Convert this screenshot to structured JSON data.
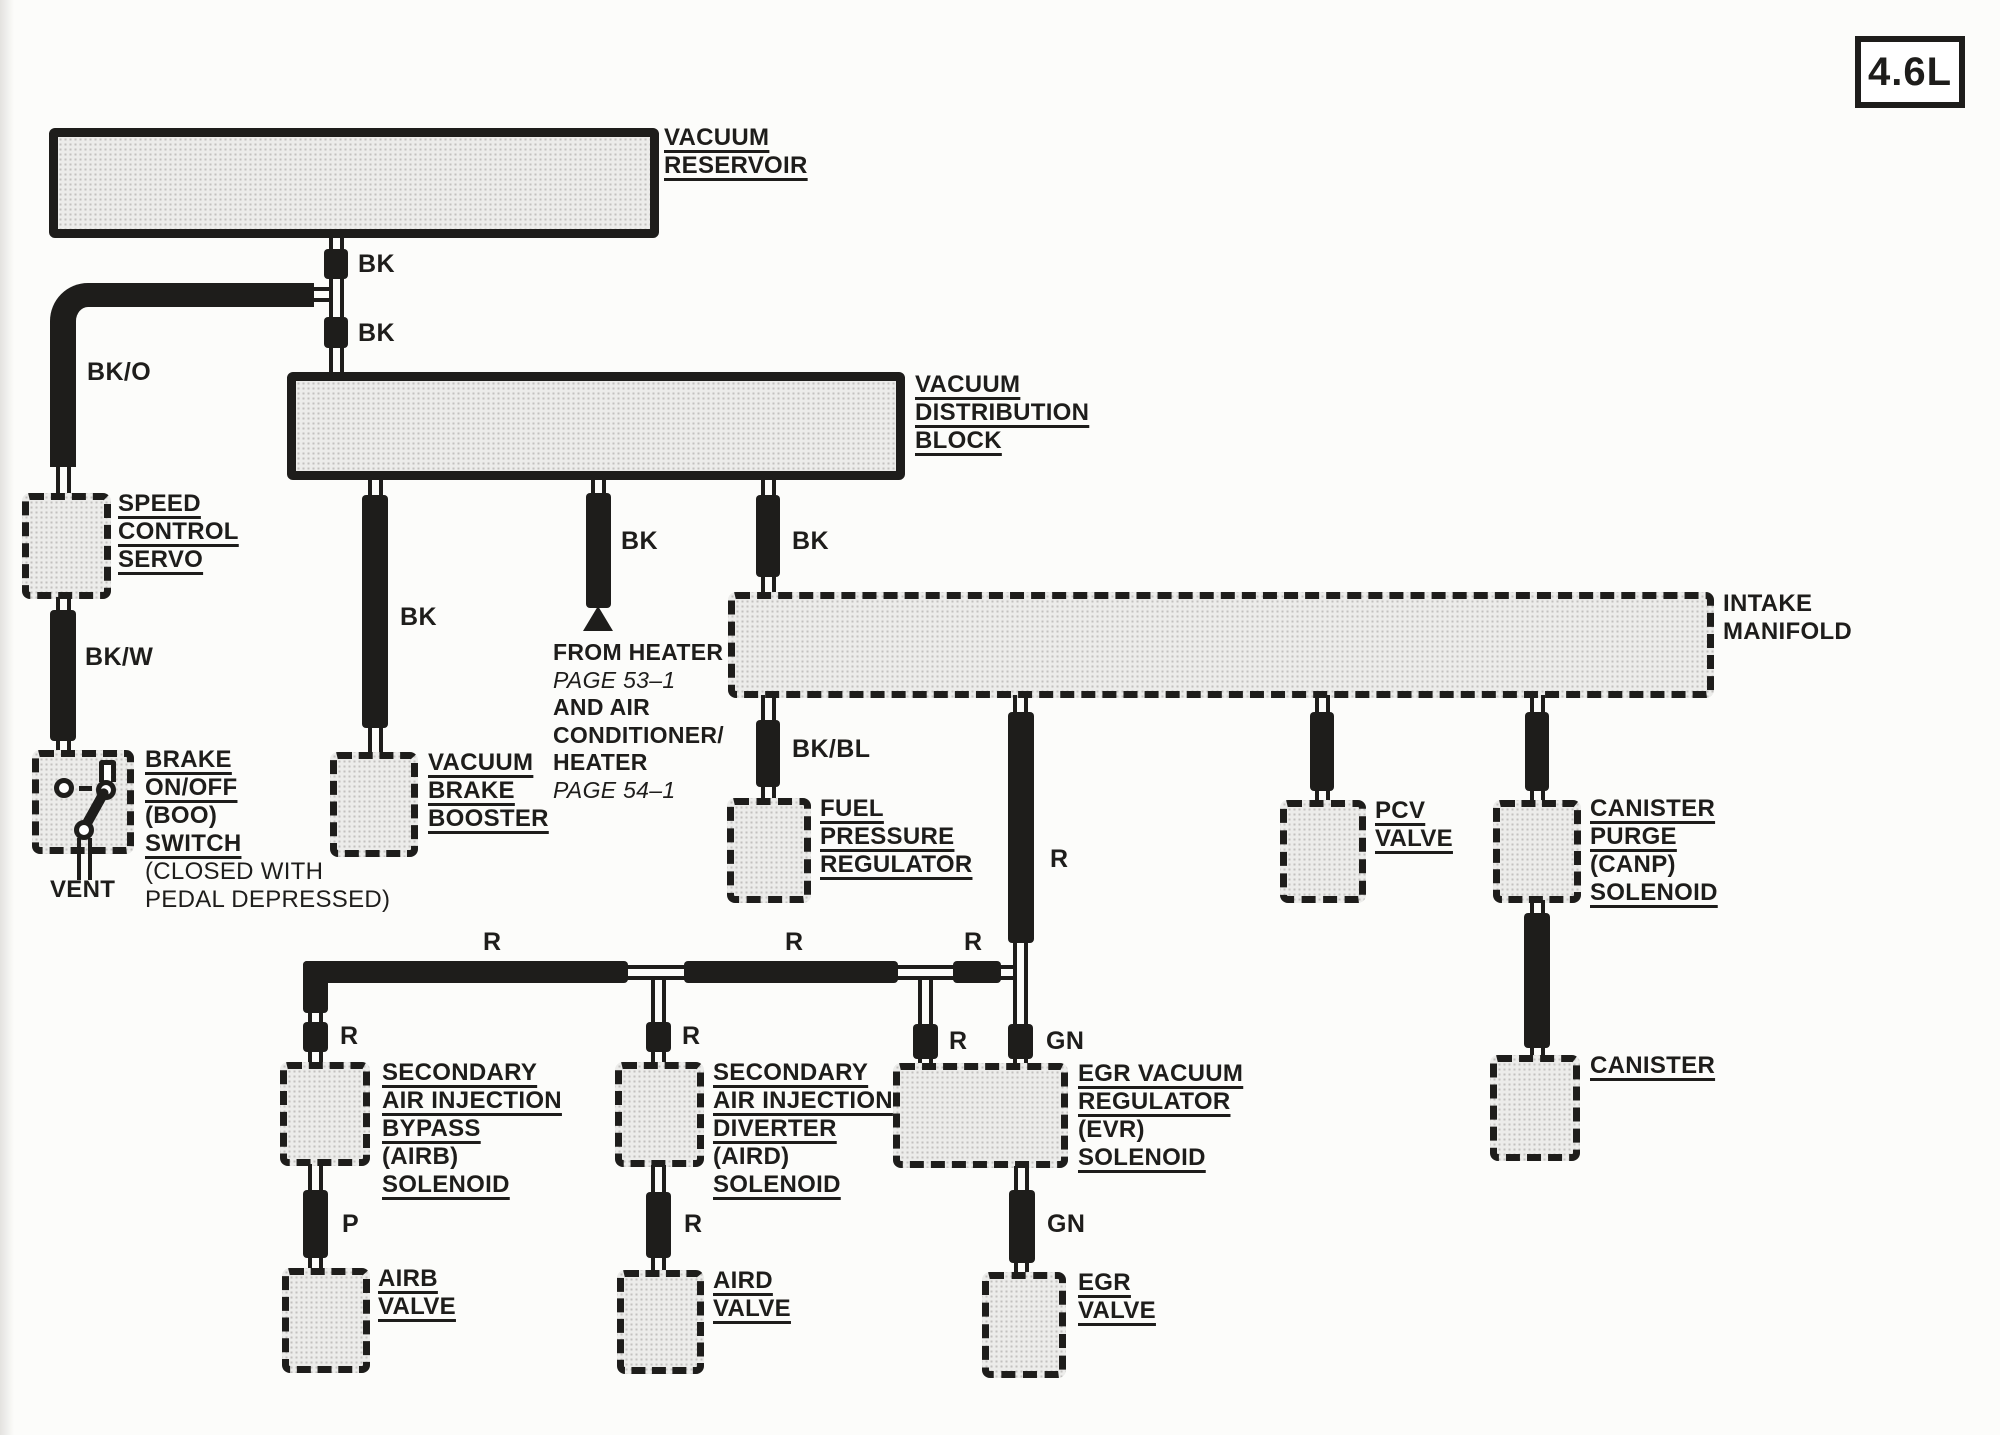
{
  "page": {
    "engine_badge": "4.6L"
  },
  "components": {
    "vacuum_reservoir": {
      "label": [
        "VACUUM",
        "RESERVOIR"
      ]
    },
    "vacuum_distribution_block": {
      "label": [
        "VACUUM",
        "DISTRIBUTION",
        "BLOCK"
      ]
    },
    "speed_control_servo": {
      "label": [
        "SPEED",
        "CONTROL",
        "SERVO"
      ]
    },
    "brake_on_off_switch": {
      "label": [
        "BRAKE",
        "ON/OFF",
        "(BOO)",
        "SWITCH"
      ],
      "note": [
        "(CLOSED WITH",
        "PEDAL DEPRESSED)"
      ],
      "vent_label": "VENT"
    },
    "vacuum_brake_booster": {
      "label": [
        "VACUUM",
        "BRAKE",
        "BOOSTER"
      ]
    },
    "heater_note": {
      "lines": [
        "FROM HEATER",
        "PAGE 53–1",
        "AND AIR",
        "CONDITIONER/",
        "HEATER",
        "PAGE 54–1"
      ]
    },
    "fuel_pressure_regulator": {
      "label": [
        "FUEL",
        "PRESSURE",
        "REGULATOR"
      ]
    },
    "intake_manifold": {
      "label": [
        "INTAKE",
        "MANIFOLD"
      ]
    },
    "pcv_valve": {
      "label": [
        "PCV",
        "VALVE"
      ]
    },
    "canister_purge_solenoid": {
      "label": [
        "CANISTER",
        "PURGE",
        "(CANP)",
        "SOLENOID"
      ]
    },
    "canister": {
      "label": [
        "CANISTER"
      ]
    },
    "airb_solenoid": {
      "label": [
        "SECONDARY",
        "AIR INJECTION",
        "BYPASS",
        "(AIRB)",
        "SOLENOID"
      ]
    },
    "aird_solenoid": {
      "label": [
        "SECONDARY",
        "AIR INJECTION",
        "DIVERTER",
        "(AIRD)",
        "SOLENOID"
      ]
    },
    "evr_solenoid": {
      "label": [
        "EGR VACUUM",
        "REGULATOR",
        "(EVR)",
        "SOLENOID"
      ]
    },
    "airb_valve": {
      "label": [
        "AIRB",
        "VALVE"
      ]
    },
    "aird_valve": {
      "label": [
        "AIRD",
        "VALVE"
      ]
    },
    "egr_valve": {
      "label": [
        "EGR",
        "VALVE"
      ]
    }
  },
  "hose_codes": {
    "reservoir_out_upper": "BK",
    "reservoir_out_lower": "BK",
    "speed_servo_feed": "BK/O",
    "boo_switch_feed": "BK/W",
    "booster_feed": "BK",
    "heater_branch": "BK",
    "manifold_feed": "BK",
    "fpr_feed": "BK/BL",
    "evr_supply": "R",
    "air_run_left": "R",
    "air_run_mid": "R",
    "air_run_right": "R",
    "airb_inlet": "R",
    "aird_inlet": "R",
    "evr_inlet_left": "R",
    "evr_inlet_right": "GN",
    "airb_valve_feed": "P",
    "aird_valve_feed": "R",
    "egr_valve_feed": "GN"
  },
  "colors": {
    "line": "#1e1d1b",
    "box_fill": "#ececea",
    "paper": "#fcfcfa"
  }
}
